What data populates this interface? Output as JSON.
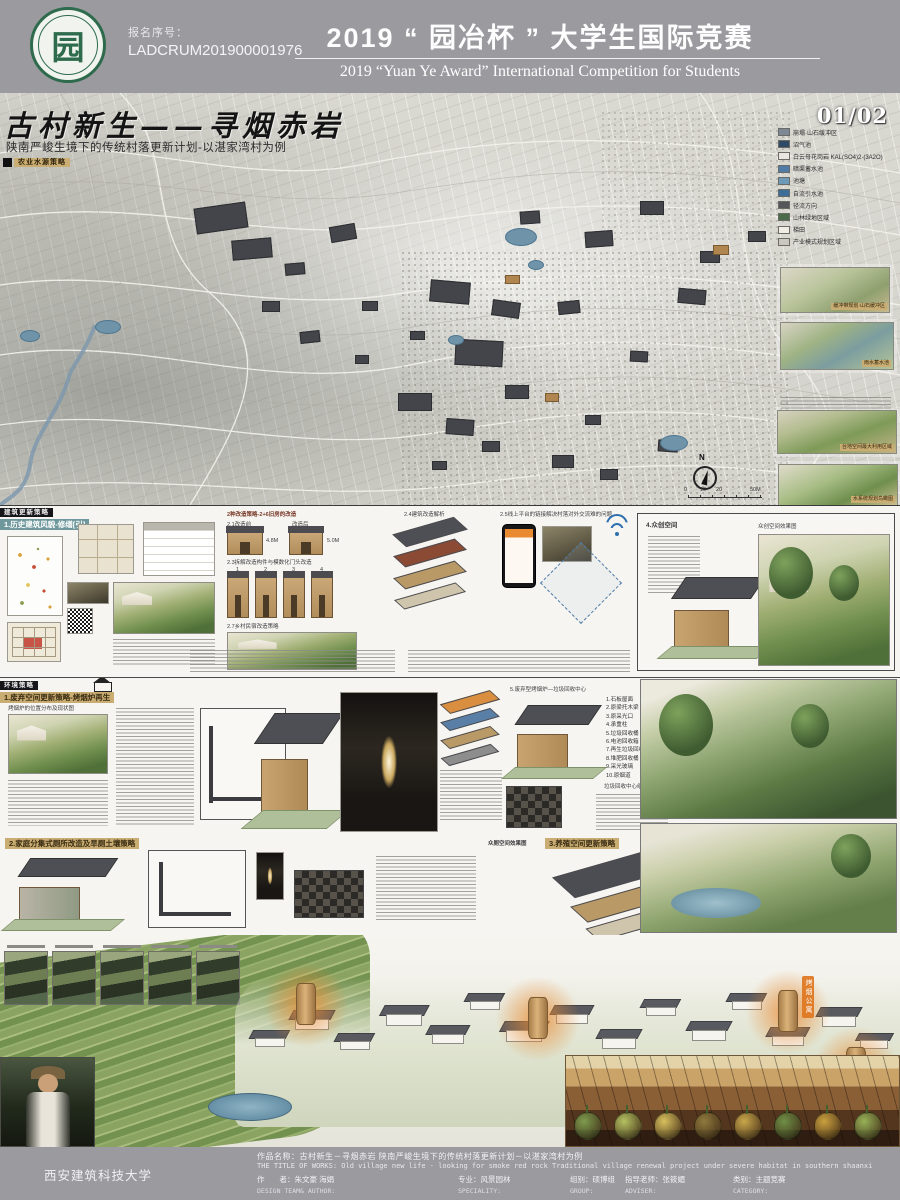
{
  "header": {
    "logo_char": "园",
    "reg_label": "报名序号：",
    "reg_number": "LADCRUM201900001976",
    "title_cn": "2019 “ 园冶杯 ” 大学生国际竞赛",
    "title_en": "2019 “Yuan Ye Award” International Competition for  Students"
  },
  "poster": {
    "page_number": "01/02",
    "main_title": "古村新生——寻烟赤岩",
    "subtitle": "陕南严峻生境下的传统村落更新计划-以湛家湾村为例",
    "map_tag": "农业水源策略",
    "north_label": "N",
    "scale_ticks": [
      "0",
      "10",
      "20",
      "50M"
    ]
  },
  "legend": {
    "items": [
      {
        "label": "崩塌·山石缓冲区",
        "color": "#7c8894"
      },
      {
        "label": "沼气池",
        "color": "#2e4a66"
      },
      {
        "label": "白云母花岗岩 KAL(SO4)2·(3A2O)",
        "color": "#e8e6df"
      },
      {
        "label": "暗渠蓄水池",
        "color": "#4f7ba6"
      },
      {
        "label": "池塘",
        "color": "#6d9ab8"
      },
      {
        "label": "自流引水池",
        "color": "#3c6e99"
      },
      {
        "label": "径流方向",
        "color": "#55565a"
      },
      {
        "label": "山林绿地区域",
        "color": "#4c6b4a"
      },
      {
        "label": "梯田",
        "color": "#efede4"
      },
      {
        "label": "产业模式规划区域",
        "color": "#c9c7c0"
      }
    ]
  },
  "insets": [
    {
      "caption": "缓冲带规划·山石缓冲区"
    },
    {
      "caption": "雨水蓄水池"
    },
    {
      "caption": "台地空间最大利用区域"
    },
    {
      "caption": "水系统规划鸟瞰图"
    }
  ],
  "map": {
    "buildings": [
      [
        195,
        112,
        52,
        26,
        -8
      ],
      [
        232,
        146,
        40,
        20,
        -5
      ],
      [
        330,
        132,
        26,
        16,
        -10
      ],
      [
        285,
        170,
        20,
        12,
        -5
      ],
      [
        430,
        188,
        40,
        22,
        5
      ],
      [
        455,
        247,
        48,
        26,
        3
      ],
      [
        492,
        208,
        28,
        16,
        8
      ],
      [
        398,
        300,
        34,
        18,
        0
      ],
      [
        446,
        326,
        28,
        16,
        4
      ],
      [
        505,
        292,
        24,
        14,
        0
      ],
      [
        558,
        208,
        22,
        13,
        -6
      ],
      [
        585,
        138,
        28,
        16,
        -4
      ],
      [
        640,
        108,
        24,
        14,
        0
      ],
      [
        678,
        196,
        28,
        15,
        5
      ],
      [
        700,
        158,
        20,
        12,
        0
      ],
      [
        748,
        138,
        18,
        11,
        0
      ],
      [
        300,
        238,
        20,
        12,
        -6
      ],
      [
        262,
        208,
        18,
        11,
        0
      ],
      [
        552,
        362,
        22,
        13,
        0
      ],
      [
        600,
        376,
        18,
        11,
        0
      ],
      [
        658,
        347,
        20,
        12,
        4
      ],
      [
        520,
        118,
        20,
        13,
        -4
      ],
      [
        362,
        208,
        16,
        10,
        0
      ],
      [
        410,
        238,
        15,
        9,
        0
      ],
      [
        482,
        348,
        18,
        11,
        0
      ],
      [
        432,
        368,
        15,
        9,
        0
      ],
      [
        585,
        322,
        16,
        10,
        0
      ],
      [
        630,
        258,
        18,
        11,
        3
      ],
      [
        713,
        152,
        16,
        10,
        0,
        "#b08550"
      ],
      [
        505,
        182,
        15,
        9,
        0,
        "#b08550"
      ],
      [
        545,
        300,
        14,
        9,
        0,
        "#b08550"
      ],
      [
        355,
        262,
        14,
        9,
        0
      ]
    ],
    "ponds": [
      [
        505,
        135,
        30,
        16
      ],
      [
        95,
        227,
        24,
        12
      ],
      [
        20,
        237,
        18,
        10
      ],
      [
        660,
        342,
        26,
        14
      ],
      [
        528,
        167,
        14,
        8
      ],
      [
        448,
        242,
        14,
        8
      ]
    ]
  },
  "sec_arch": {
    "bar": "建筑更新策略",
    "title": "1.历史建筑风貌-修缮[引]",
    "strategies_header": "2种改造策略-2+6旧房的改造",
    "before_label": "2.1改造前",
    "after_label": "改造后",
    "height_label": "4.8M",
    "height_label2": "5.0M",
    "c23": "2.3拆解改造构件与模数化门头改造",
    "facade_nums": [
      "1",
      "2",
      "3",
      "4"
    ],
    "c24": "2.4建筑改造解析",
    "c25": "2.5线上平台的链接解决村落对外交流难的问题",
    "c27": "2.7乡村民宿改造策略"
  },
  "sec_space": {
    "label": "4.众创空间",
    "render_caption": "众创空间效果图"
  },
  "sec_env": {
    "bar": "环境策略",
    "title": "1.废弃空间更新策略-烤烟炉再生",
    "c_map": "烤烟炉的位置分布及现状图",
    "c_recycle": "5.废弃型烤烟炉—垃圾回收中心",
    "recycle_list": [
      "1.石板屋面",
      "2.原梁托木梁",
      "3.原采光口",
      "4.承重柱",
      "5.垃圾回收桶",
      "6.电池回收箱",
      "7.再生垃圾回收箱",
      "8.堆肥回收桶",
      "9.采光玻璃",
      "10.原烟道"
    ],
    "recycle_caption": "垃圾回收中心组构图"
  },
  "sec_toilet": {
    "title": "2.家庭分集式厕所改造及旱厕土壤策略",
    "render_caption": "众厕空间效果图"
  },
  "sec_farm": {
    "title": "3.养殖空间更新策略"
  },
  "bottom": {
    "tower_label": "烤烟公寓",
    "houses": [
      [
        255,
        95,
        30
      ],
      [
        295,
        75,
        34
      ],
      [
        340,
        98,
        30
      ],
      [
        386,
        70,
        36
      ],
      [
        432,
        90,
        32
      ],
      [
        470,
        58,
        30
      ],
      [
        506,
        86,
        36
      ],
      [
        556,
        70,
        32
      ],
      [
        602,
        94,
        34
      ],
      [
        646,
        64,
        30
      ],
      [
        692,
        86,
        34
      ],
      [
        732,
        58,
        30
      ],
      [
        772,
        92,
        32
      ],
      [
        822,
        72,
        34
      ],
      [
        860,
        98,
        28
      ]
    ],
    "towers": [
      {
        "x": 296,
        "y": 48
      },
      {
        "x": 528,
        "y": 62
      },
      {
        "x": 778,
        "y": 55,
        "label": true
      },
      {
        "x": 846,
        "y": 112
      }
    ],
    "crop_colors": [
      "#7d9c4e",
      "#b4c261",
      "#d8c15e",
      "#8f7a3d",
      "#c9a84c",
      "#6f8f46",
      "#caa13f",
      "#97b257"
    ]
  },
  "footer": {
    "school": "西安建筑科技大学",
    "title_cn": "作品名称：古村新生－寻烟赤岩  陕南严峻生境下的传统村落更新计划－以湛家湾村为例",
    "title_en": "THE TITLE OF WORKS: Old village new life - looking for smoke red rock  Traditional village renewal project under severe habitat in southern shaanxi",
    "cols": [
      {
        "cn": "作　　者：朱文豪 海娟",
        "en": "DESIGN TEAM& AUTHOR:"
      },
      {
        "cn": "专业：风景园林",
        "en": "SPECIALITY:"
      },
      {
        "cn": "组别：硕博组",
        "en": "GROUP:"
      },
      {
        "cn": "指导老师：张筱媚",
        "en": "ADVISER:"
      },
      {
        "cn": "类别：主题竞赛",
        "en": "CATEGORY:"
      }
    ]
  }
}
